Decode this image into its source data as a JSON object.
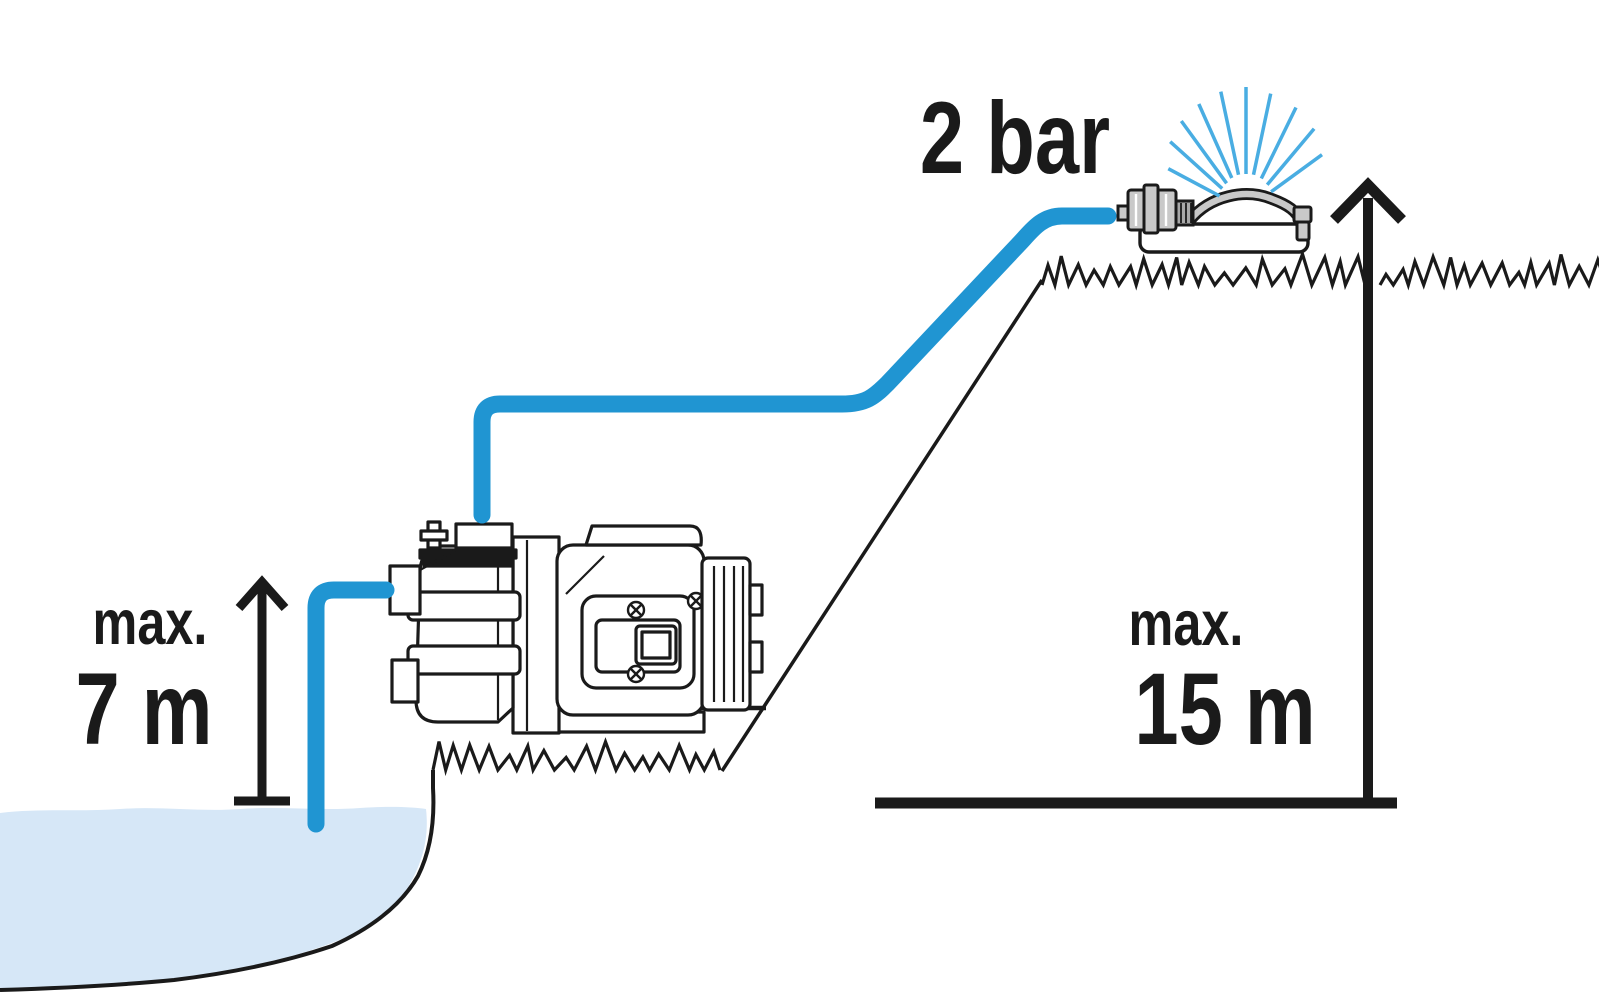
{
  "diagram": {
    "type": "pump-installation-height-diagram",
    "labels": {
      "pressure": "2 bar",
      "suction_prefix": "max.",
      "suction_value": "7 m",
      "delivery_prefix": "max.",
      "delivery_value": "15 m"
    },
    "colors": {
      "ink": "#1a1a1a",
      "hose-blue": "#2095d2",
      "spray-blue": "#49ade2",
      "water-fill": "#d6e7f7",
      "metal-gray": "#c9c9c9",
      "metal-dark": "#a8a8a8"
    },
    "icons": {
      "garden-pump-icon": "line-art garden pump",
      "oscillating-sprinkler-icon": "line-art oscillating sprinkler",
      "water-spray-icon": "fan of blue spray lines",
      "suction-height-arrow": "vertical measure arrow for suction height",
      "delivery-height-arrow": "vertical measure arrow for delivery height",
      "pond-water-icon": "light blue water basin"
    }
  }
}
